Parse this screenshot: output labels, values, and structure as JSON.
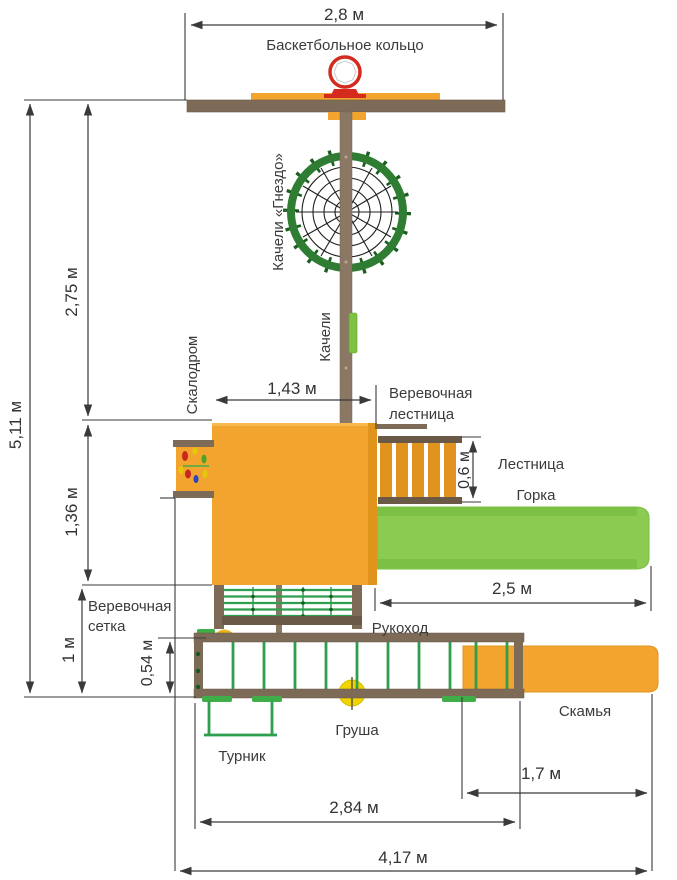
{
  "labels": {
    "basketball_hoop": "Баскетбольное кольцо",
    "nest_swing": "Качели «Гнездо»",
    "swing": "Качели",
    "climbing_wall": "Скалодром",
    "rope_ladder": "Веревочная лестница",
    "ladder": "Лестница",
    "slide": "Горка",
    "rope_net": "Веревочная сетка",
    "monkey_bars": "Рукоход",
    "punching_bag": "Груша",
    "pullup_bar": "Турник",
    "bench": "Скамья"
  },
  "dimensions": {
    "hoop_beam_width": "2,8 м",
    "total_height": "5,11 м",
    "upper_section_height": "2,75 м",
    "platform_width": "1,43 м",
    "middle_section_height": "1,36 м",
    "ladder_width": "0,6 м",
    "slide_length": "2,5 м",
    "net_section_height": "1 м",
    "net_offset_height": "0,54 м",
    "bench_length": "1,7 м",
    "monkey_bars_length": "2,84 м",
    "total_width": "4,17 м"
  },
  "colors": {
    "wood_orange": "#F2A42F",
    "wood_brown": "#7D6B58",
    "wood_brown_dark": "#6B5947",
    "post_brown": "#8A7764",
    "slide_green": "#8CCB52",
    "ring_green": "#2E7D32",
    "rung_green": "#2E9E4F",
    "pad_green": "#3FAE49",
    "accent_yellow": "#F2D500",
    "hoop_red": "#D42B1E",
    "dimension_line": "#3a3a3a"
  }
}
